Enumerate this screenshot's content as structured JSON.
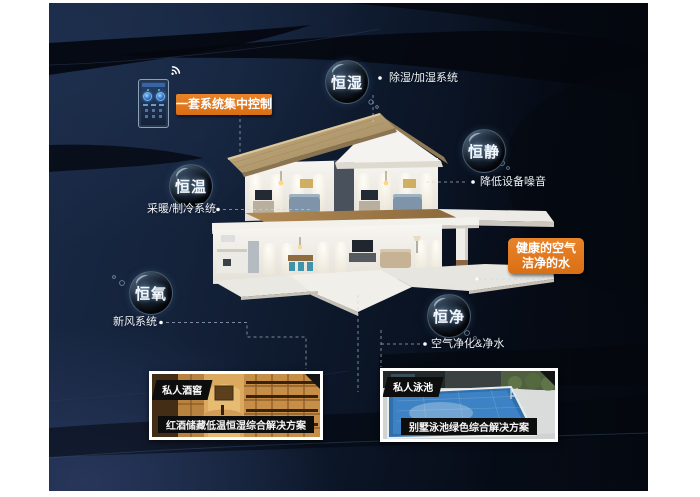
{
  "colors": {
    "accent_orange": "#DF7518",
    "panel_navy": "#101d31"
  },
  "control": {
    "banner": "一套系统集中控制",
    "wifi_icon": "wifi-signal-icon",
    "phone_icon": "smart-home-app-phone"
  },
  "nodes": [
    {
      "key": "humidity",
      "bubble": "恒湿",
      "label": "除湿/加湿系统"
    },
    {
      "key": "quiet",
      "bubble": "恒静",
      "label": "降低设备噪音"
    },
    {
      "key": "temperature",
      "bubble": "恒温",
      "label": "采暖/制冷系统"
    },
    {
      "key": "oxygen",
      "bubble": "恒氧",
      "label": "新风系统"
    },
    {
      "key": "purity",
      "bubble": "恒净",
      "label": "空气净化&净水"
    }
  ],
  "highlight": {
    "line1": "健康的空气",
    "line2": "洁净的水"
  },
  "photos": [
    {
      "tag": "私人酒窖",
      "caption": "红酒储藏低温恒湿综合解决方案",
      "scene": "wine-cellar-photo"
    },
    {
      "tag": "私人泳池",
      "caption": "别墅泳池绿色综合解决方案",
      "scene": "villa-pool-photo"
    }
  ]
}
